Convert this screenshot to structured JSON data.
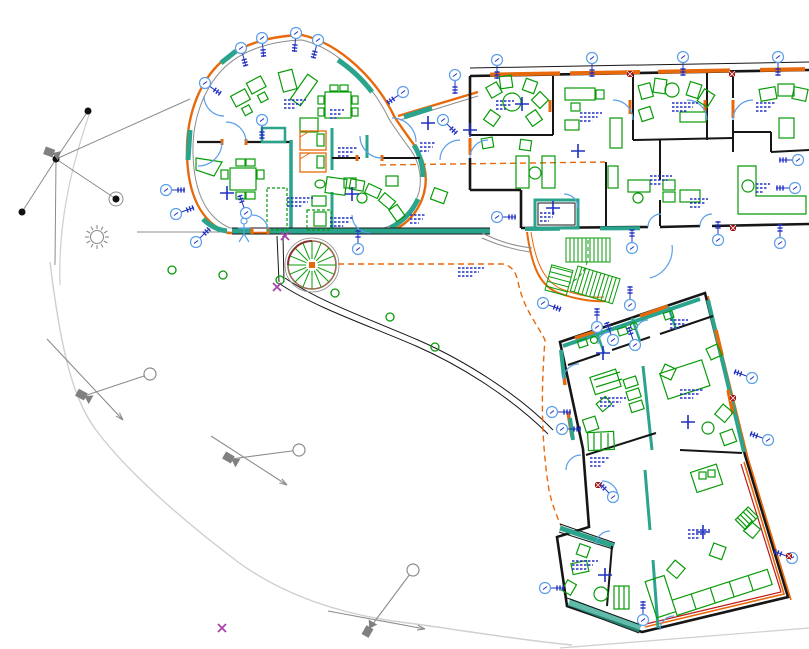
{
  "drawing": {
    "type": "architectural-floor-plan",
    "visible_text": "none-legible"
  },
  "colors": {
    "wall_orange": "#E8690B",
    "glazing_teal": "#2BA48D",
    "furniture_green": "#089B08",
    "wall_dark": "#161616",
    "annotation_blue": "#2030C0",
    "door_swing_blue": "#5C9FE8",
    "site_gray": "#8C8C8C",
    "path_light_gray": "#CFCFCF",
    "accent_red": "#C01818",
    "stair_brown": "#9A6A52",
    "marker_magenta": "#AA44AA",
    "background": "#FFFFFF"
  },
  "markers": {
    "balloons": [
      [
        205,
        83,
        35
      ],
      [
        241,
        48,
        75
      ],
      [
        262,
        38,
        85
      ],
      [
        296,
        33,
        95
      ],
      [
        318,
        40,
        105
      ],
      [
        403,
        92,
        145
      ],
      [
        166,
        190,
        0
      ],
      [
        176,
        214,
        340
      ],
      [
        196,
        242,
        315
      ],
      [
        246,
        213,
        250
      ],
      [
        262,
        120,
        90
      ],
      [
        358,
        249,
        270
      ],
      [
        455,
        75,
        90
      ],
      [
        443,
        120,
        45
      ],
      [
        497,
        60,
        90
      ],
      [
        592,
        58,
        90
      ],
      [
        683,
        57,
        90
      ],
      [
        778,
        57,
        90
      ],
      [
        798,
        160,
        180
      ],
      [
        795,
        188,
        180
      ],
      [
        497,
        217,
        0
      ],
      [
        543,
        303,
        20
      ],
      [
        597,
        327,
        270
      ],
      [
        630,
        305,
        270
      ],
      [
        632,
        248,
        270
      ],
      [
        718,
        240,
        270
      ],
      [
        780,
        243,
        270
      ],
      [
        613,
        340,
        250
      ],
      [
        635,
        345,
        250
      ],
      [
        552,
        412,
        0
      ],
      [
        562,
        429,
        0
      ],
      [
        545,
        588,
        0
      ],
      [
        613,
        497,
        225
      ],
      [
        643,
        620,
        270
      ],
      [
        752,
        378,
        200
      ],
      [
        768,
        440,
        200
      ],
      [
        792,
        558,
        200
      ]
    ],
    "crosses": [
      [
        227,
        193
      ],
      [
        352,
        194
      ],
      [
        428,
        123
      ],
      [
        470,
        130
      ],
      [
        522,
        104
      ],
      [
        578,
        151
      ],
      [
        553,
        208
      ],
      [
        603,
        353
      ],
      [
        688,
        422
      ],
      [
        605,
        575
      ],
      [
        703,
        532
      ]
    ],
    "annotations": [
      [
        284,
        100,
        22
      ],
      [
        338,
        148,
        20
      ],
      [
        287,
        198,
        26
      ],
      [
        330,
        218,
        24
      ],
      [
        458,
        268,
        26
      ],
      [
        496,
        101,
        18
      ],
      [
        580,
        113,
        22
      ],
      [
        672,
        103,
        26
      ],
      [
        756,
        103,
        20
      ],
      [
        650,
        176,
        22
      ],
      [
        690,
        199,
        18
      ],
      [
        540,
        213,
        16
      ],
      [
        670,
        320,
        18
      ],
      [
        680,
        390,
        24
      ],
      [
        600,
        398,
        26
      ],
      [
        688,
        530,
        22
      ],
      [
        572,
        561,
        26
      ],
      [
        590,
        458,
        20
      ],
      [
        756,
        184,
        14
      ],
      [
        420,
        143,
        16
      ],
      [
        330,
        110,
        14
      ],
      [
        410,
        215,
        16
      ]
    ],
    "green_shrubs": [
      [
        280,
        280
      ],
      [
        335,
        293
      ],
      [
        390,
        317
      ],
      [
        435,
        347
      ],
      [
        172,
        270
      ],
      [
        223,
        275
      ]
    ],
    "red_squares": [
      [
        630,
        74
      ],
      [
        732,
        74
      ],
      [
        733,
        228
      ],
      [
        733,
        398
      ],
      [
        789,
        556
      ],
      [
        598,
        485
      ]
    ],
    "magenta_x": [
      [
        285,
        236
      ],
      [
        277,
        287
      ],
      [
        222,
        628
      ]
    ],
    "cameras": [
      {
        "x": 52,
        "y": 153,
        "rot": 20,
        "arrow": null,
        "target": null
      },
      {
        "x": 84,
        "y": 396,
        "rot": 28,
        "arrow": [
          47,
          339,
          123,
          420
        ],
        "target": [
          150,
          374
        ]
      },
      {
        "x": 231,
        "y": 459,
        "rot": 30,
        "arrow": [
          211,
          436,
          287,
          485
        ],
        "target": [
          299,
          450
        ]
      },
      {
        "x": 369,
        "y": 629,
        "rot": -60,
        "arrow": [
          328,
          611,
          425,
          629
        ],
        "target": [
          413,
          570
        ]
      }
    ],
    "site_nodes": [
      [
        88,
        111
      ],
      [
        56,
        159
      ],
      [
        22,
        212
      ],
      [
        116,
        199
      ]
    ],
    "site_edges": [
      [
        56,
        159,
        88,
        111
      ],
      [
        56,
        159,
        22,
        212
      ],
      [
        56,
        159,
        116,
        199
      ],
      [
        56,
        159,
        190,
        99
      ],
      [
        56,
        159,
        55,
        265
      ]
    ],
    "circled_node": [
      116,
      199
    ],
    "sun": {
      "x": 97,
      "y": 237
    },
    "spiral_stair": {
      "cx": 312,
      "cy": 265,
      "r": 24,
      "treads": 16
    }
  }
}
